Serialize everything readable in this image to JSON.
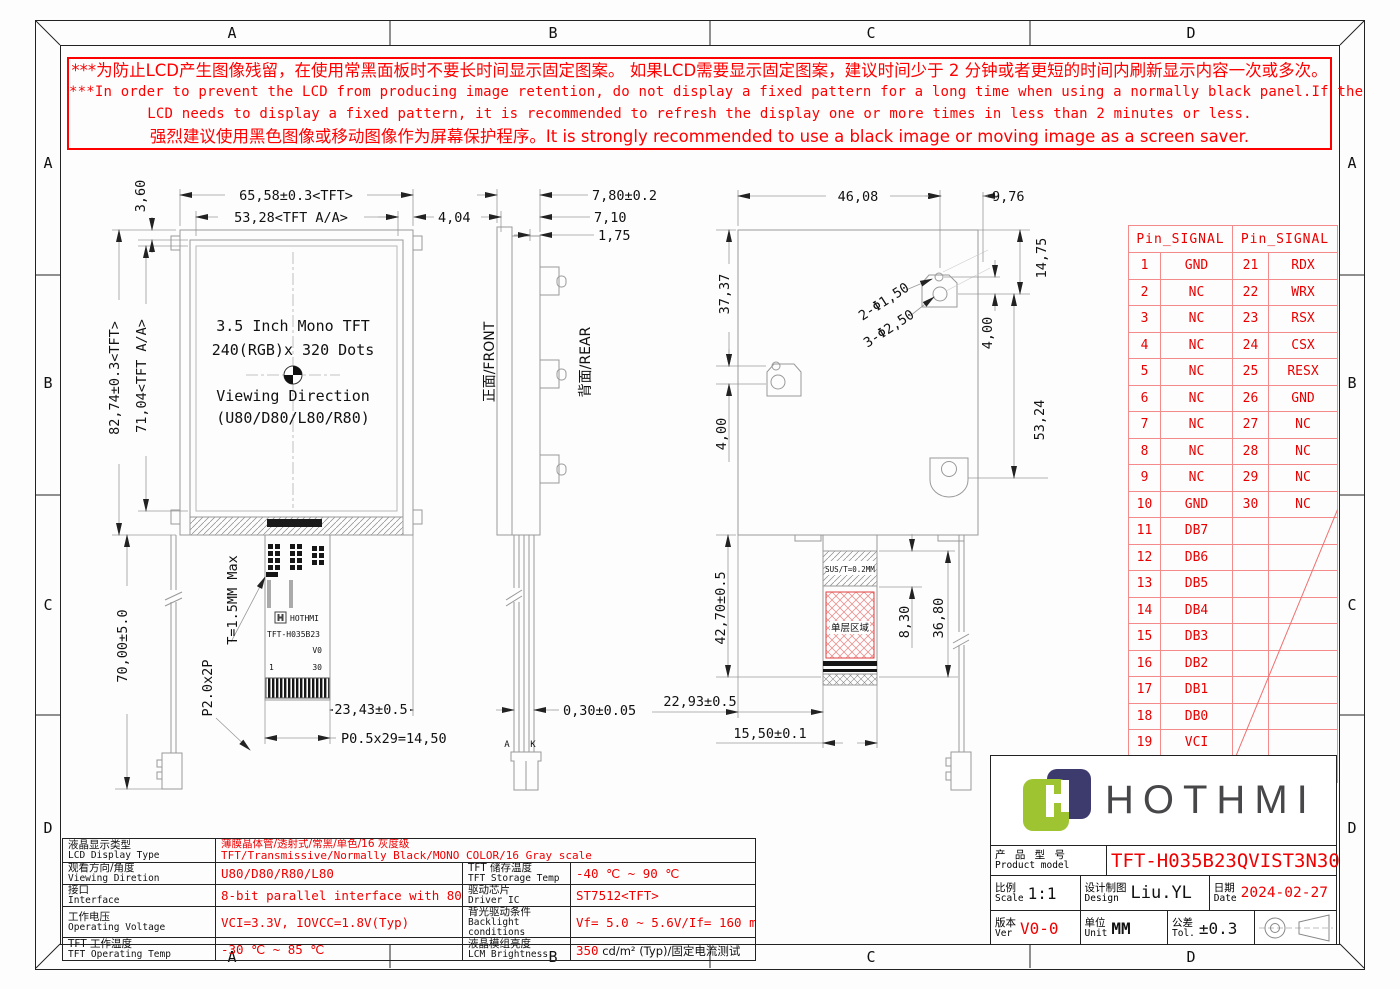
{
  "frame": {
    "grid_letters": [
      "A",
      "B",
      "C",
      "D"
    ]
  },
  "warning": {
    "lines": [
      "***为防止LCD产生图像残留，在使用常黑面板时不要长时间显示固定图案。 如果LCD需要显示固定图案，建议时间少于 2 分钟或者更短的时间内刷新显示内容一次或多次。",
      "***In order to prevent the LCD from producing image retention, do not display a fixed pattern for a long time when using a normally black panel.If the",
      "LCD needs to display a fixed pattern,  it is recommended to refresh the display one or more times in less than 2 minutes or less.",
      "强烈建议使用黑色图像或移动图像作为屏幕保护程序。It is strongly recommended to use a black image or moving image as a screen saver."
    ]
  },
  "views": {
    "front": {
      "dim_corner": "3,60",
      "dim_top_width": "65,58±0.3<TFT>",
      "dim_top_aa": "53,28<TFT A/A>",
      "dim_right_offset": "4,04",
      "dim_left_height": "82,74±0.3<TFT>",
      "dim_left_aa": "71,04<TFT A/A>",
      "line1": "3.5 Inch Mono TFT",
      "line2": "240(RGB)x 320 Dots",
      "line3": "Viewing Direction",
      "line4": "(U80/D80/L80/R80)",
      "dim_fpc_length": "70,00±5.0",
      "dim_connector": "P2.0x2P",
      "dim_thickness": "T=1.5MM Max",
      "dim_fpc_right": "23,43±0.5",
      "dim_fpc_pitch": "P0.5x29=14,50",
      "fpc_brand": "HOTHMI",
      "fpc_model": "TFT-H035B23",
      "fpc_ver": "V0",
      "fpc_pin_first": "1",
      "fpc_pin_last": "30"
    },
    "side": {
      "dim_total_thk": "7,80±0.2",
      "dim_thk2": "7,10",
      "dim_peg": "1,75",
      "label_front": "正面/FRONT",
      "label_rear": "背面/REAR",
      "dim_fpc_thk": "0,30±0.05",
      "anode": "A",
      "cathode": "K"
    },
    "rear": {
      "dim_top": "46,08",
      "dim_top_right": "9,76",
      "dim_left_upper": "37,37",
      "dim_left_lower": "4,00",
      "dim_right_top": "14,75",
      "dim_right_mid": "4,00",
      "dim_right_main": "53,24",
      "holes_small": "2-Φ1,50",
      "holes_large": "3-Φ2,50",
      "sus_label": "SUS/T=0.2MM",
      "single_layer": "单层区域",
      "dim_tail_len": "42,70±0.5",
      "dim_sus_len": "8,30",
      "dim_tail_total": "36,80",
      "dim_tail_offset": "22,93±0.5",
      "dim_tail_width": "15,50±0.1"
    }
  },
  "pin_table": {
    "header": "Pin_SIGNAL",
    "rows": [
      [
        "1",
        "GND",
        "21",
        "RDX"
      ],
      [
        "2",
        "NC",
        "22",
        "WRX"
      ],
      [
        "3",
        "NC",
        "23",
        "RSX"
      ],
      [
        "4",
        "NC",
        "24",
        "CSX"
      ],
      [
        "5",
        "NC",
        "25",
        "RESX"
      ],
      [
        "6",
        "NC",
        "26",
        "GND"
      ],
      [
        "7",
        "NC",
        "27",
        "NC"
      ],
      [
        "8",
        "NC",
        "28",
        "NC"
      ],
      [
        "9",
        "NC",
        "29",
        "NC"
      ],
      [
        "10",
        "GND",
        "30",
        "NC"
      ],
      [
        "11",
        "DB7",
        "",
        ""
      ],
      [
        "12",
        "DB6",
        "",
        ""
      ],
      [
        "13",
        "DB5",
        "",
        ""
      ],
      [
        "14",
        "DB4",
        "",
        ""
      ],
      [
        "15",
        "DB3",
        "",
        ""
      ],
      [
        "16",
        "DB2",
        "",
        ""
      ],
      [
        "17",
        "DB1",
        "",
        ""
      ],
      [
        "18",
        "DB0",
        "",
        ""
      ],
      [
        "19",
        "VCI",
        "",
        ""
      ],
      [
        "20",
        "VCI",
        "",
        ""
      ]
    ]
  },
  "spec_table": {
    "row1": {
      "label_cn": "液晶显示类型",
      "label_en": "LCD Display Type",
      "value_cn": "薄膜晶体管/透射式/常黑/单色/16 灰度级",
      "value_en": "TFT/Transmissive/Normally Black/MONO COLOR/16 Gray scale"
    },
    "rows": [
      {
        "label_cn": "观看方向/角度",
        "label_en": "Viewing Diretion",
        "value": "U80/D80/R80/L80",
        "label2_cn": "TFT 储存温度",
        "label2_en": "TFT Storage Temp",
        "value2": "-40 ℃ ~ 90 ℃"
      },
      {
        "label_cn": "接口",
        "label_en": "Interface",
        "value": "8-bit parallel interface with 8080",
        "label2_cn": "驱动芯片",
        "label2_en": "Driver IC",
        "value2": "ST7512<TFT>"
      },
      {
        "label_cn": "工作电压",
        "label_en": "Operating Voltage",
        "value": "VCI=3.3V, IOVCC=1.8V(Typ)",
        "label2_cn": "背光驱动条件",
        "label2_en": "Backlight conditions",
        "value2": "Vf= 5.0 ~ 5.6V/If= 160 mA"
      },
      {
        "label_cn": "TFT 工作温度",
        "label_en": "TFT Operating Temp",
        "value": "-30 ℃ ~ 85 ℃",
        "label2_cn": "液晶模组亮度",
        "label2_en": "LCM Brightness",
        "value2_red": "350",
        "value2_black": " cd/m² (Typ)/固定电流测试"
      }
    ]
  },
  "title_block": {
    "brand": "HOTHMI",
    "product_label_cn": "产 品 型 号",
    "product_label_en": "Product model",
    "product_value": "TFT-H035B23QVIST3N30",
    "scale_label_cn": "比例",
    "scale_label_en": "Scale",
    "scale_value": "1:1",
    "design_label_cn": "设计制图",
    "design_label_en": "Design",
    "design_value": "Liu.YL",
    "date_label_cn": "日期",
    "date_label_en": "Date",
    "date_value": "2024-02-27",
    "ver_label_cn": "版本",
    "ver_label_en": "Ver",
    "ver_value": "V0-0",
    "unit_label_cn": "单位",
    "unit_label_en": "Unit",
    "unit_value": "MM",
    "tol_label_cn": "公差",
    "tol_label_en": "Tol.",
    "tol_value": "±0.3"
  },
  "colors": {
    "red": "#ee0000",
    "logo_green": "#9ec431",
    "logo_navy": "#3d3b6e",
    "brand_gray": "#47474a",
    "line_gray": "#999999"
  }
}
